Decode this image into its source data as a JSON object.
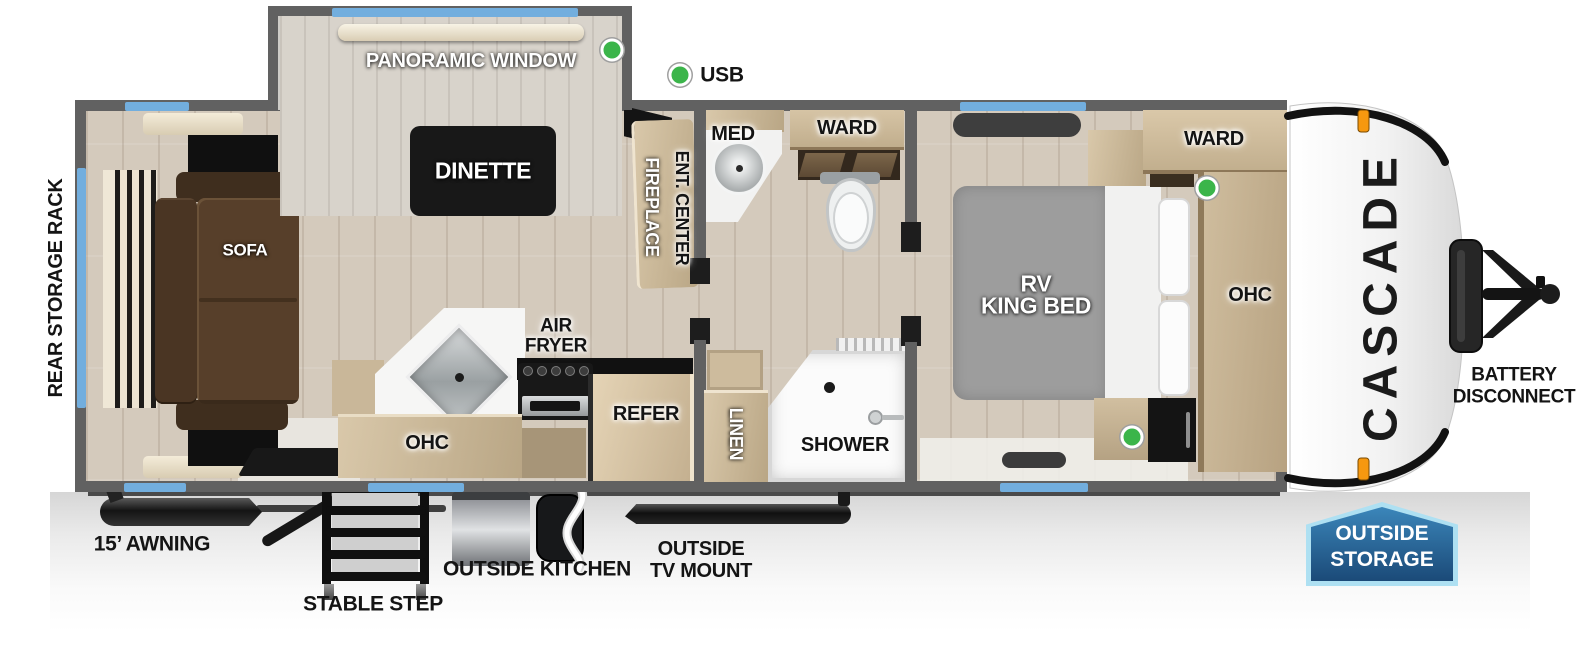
{
  "title": "Cascade travel trailer floorplan",
  "brand": {
    "logo": "CASCADE"
  },
  "legend": {
    "usb": "USB"
  },
  "rooms": {
    "dinette_slide": {
      "window": "PANORAMIC WINDOW",
      "table": "DINETTE"
    },
    "living": {
      "sofa": "SOFA",
      "rear_rack": "REAR STORAGE RACK"
    },
    "entry": {
      "fireplace": "FIREPLACE",
      "ent_center": "ENT. CENTER"
    },
    "kitchen": {
      "air_fryer_line1": "AIR",
      "air_fryer_line2": "FRYER",
      "ohc": "OHC",
      "refer": "REFER"
    },
    "bath": {
      "med": "MED",
      "ward": "WARD",
      "linen": "LINEN",
      "shower": "SHOWER"
    },
    "bedroom": {
      "bed_line1": "RV",
      "bed_line2": "KING BED",
      "ward": "WARD",
      "ohc": "OHC"
    }
  },
  "exterior": {
    "awning": "15’ AWNING",
    "stable_step": "STABLE STEP",
    "outside_kitchen": "OUTSIDE KITCHEN",
    "tv_line1": "OUTSIDE",
    "tv_line2": "TV MOUNT",
    "battery_line1": "BATTERY",
    "battery_line2": "DISCONNECT",
    "storage_line1": "OUTSIDE",
    "storage_line2": "STORAGE"
  },
  "colors": {
    "wall_gray": "#616161",
    "floor_tan": "#d4cabc",
    "cabinet_wood": "#cbb89a",
    "sofa_brown": "#523c28",
    "bed_gray": "#9d9d9d",
    "window_blue": "#72aede",
    "usb_green": "#3bb54a",
    "marker_orange": "#f6980f",
    "badge_blue_top": "#3b86ba",
    "badge_blue_bottom": "#1b4a78",
    "badge_border": "#aee0f2"
  }
}
